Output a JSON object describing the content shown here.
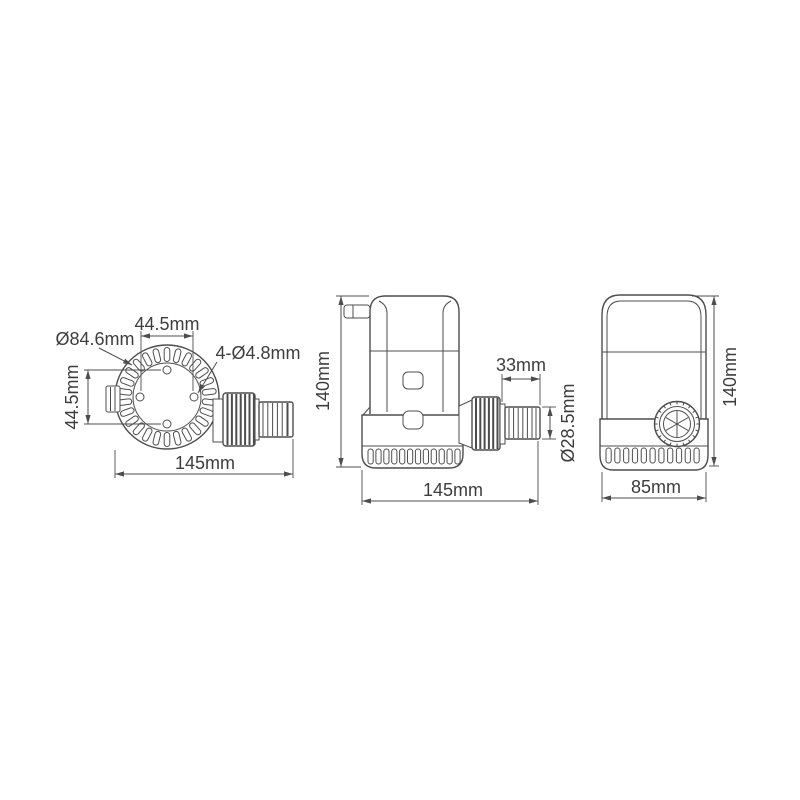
{
  "drawing": {
    "type": "technical-dimension-drawing",
    "subject": "bilge-pump",
    "colors": {
      "line": "#4d4d4d",
      "text": "#3d3d3d",
      "background": "#ffffff"
    },
    "views": {
      "top_view": {
        "hole_spacing_horizontal": "44.5mm",
        "body_diameter": "Ø84.6mm",
        "mounting_holes": "4-Ø4.8mm",
        "hole_spacing_vertical": "44.5mm",
        "overall_length": "145mm"
      },
      "front_view": {
        "height": "140mm",
        "barb_length": "33mm",
        "outlet_diameter": "Ø28.5mm",
        "overall_length": "145mm"
      },
      "side_view": {
        "height": "140mm",
        "body_width": "85mm"
      }
    }
  }
}
